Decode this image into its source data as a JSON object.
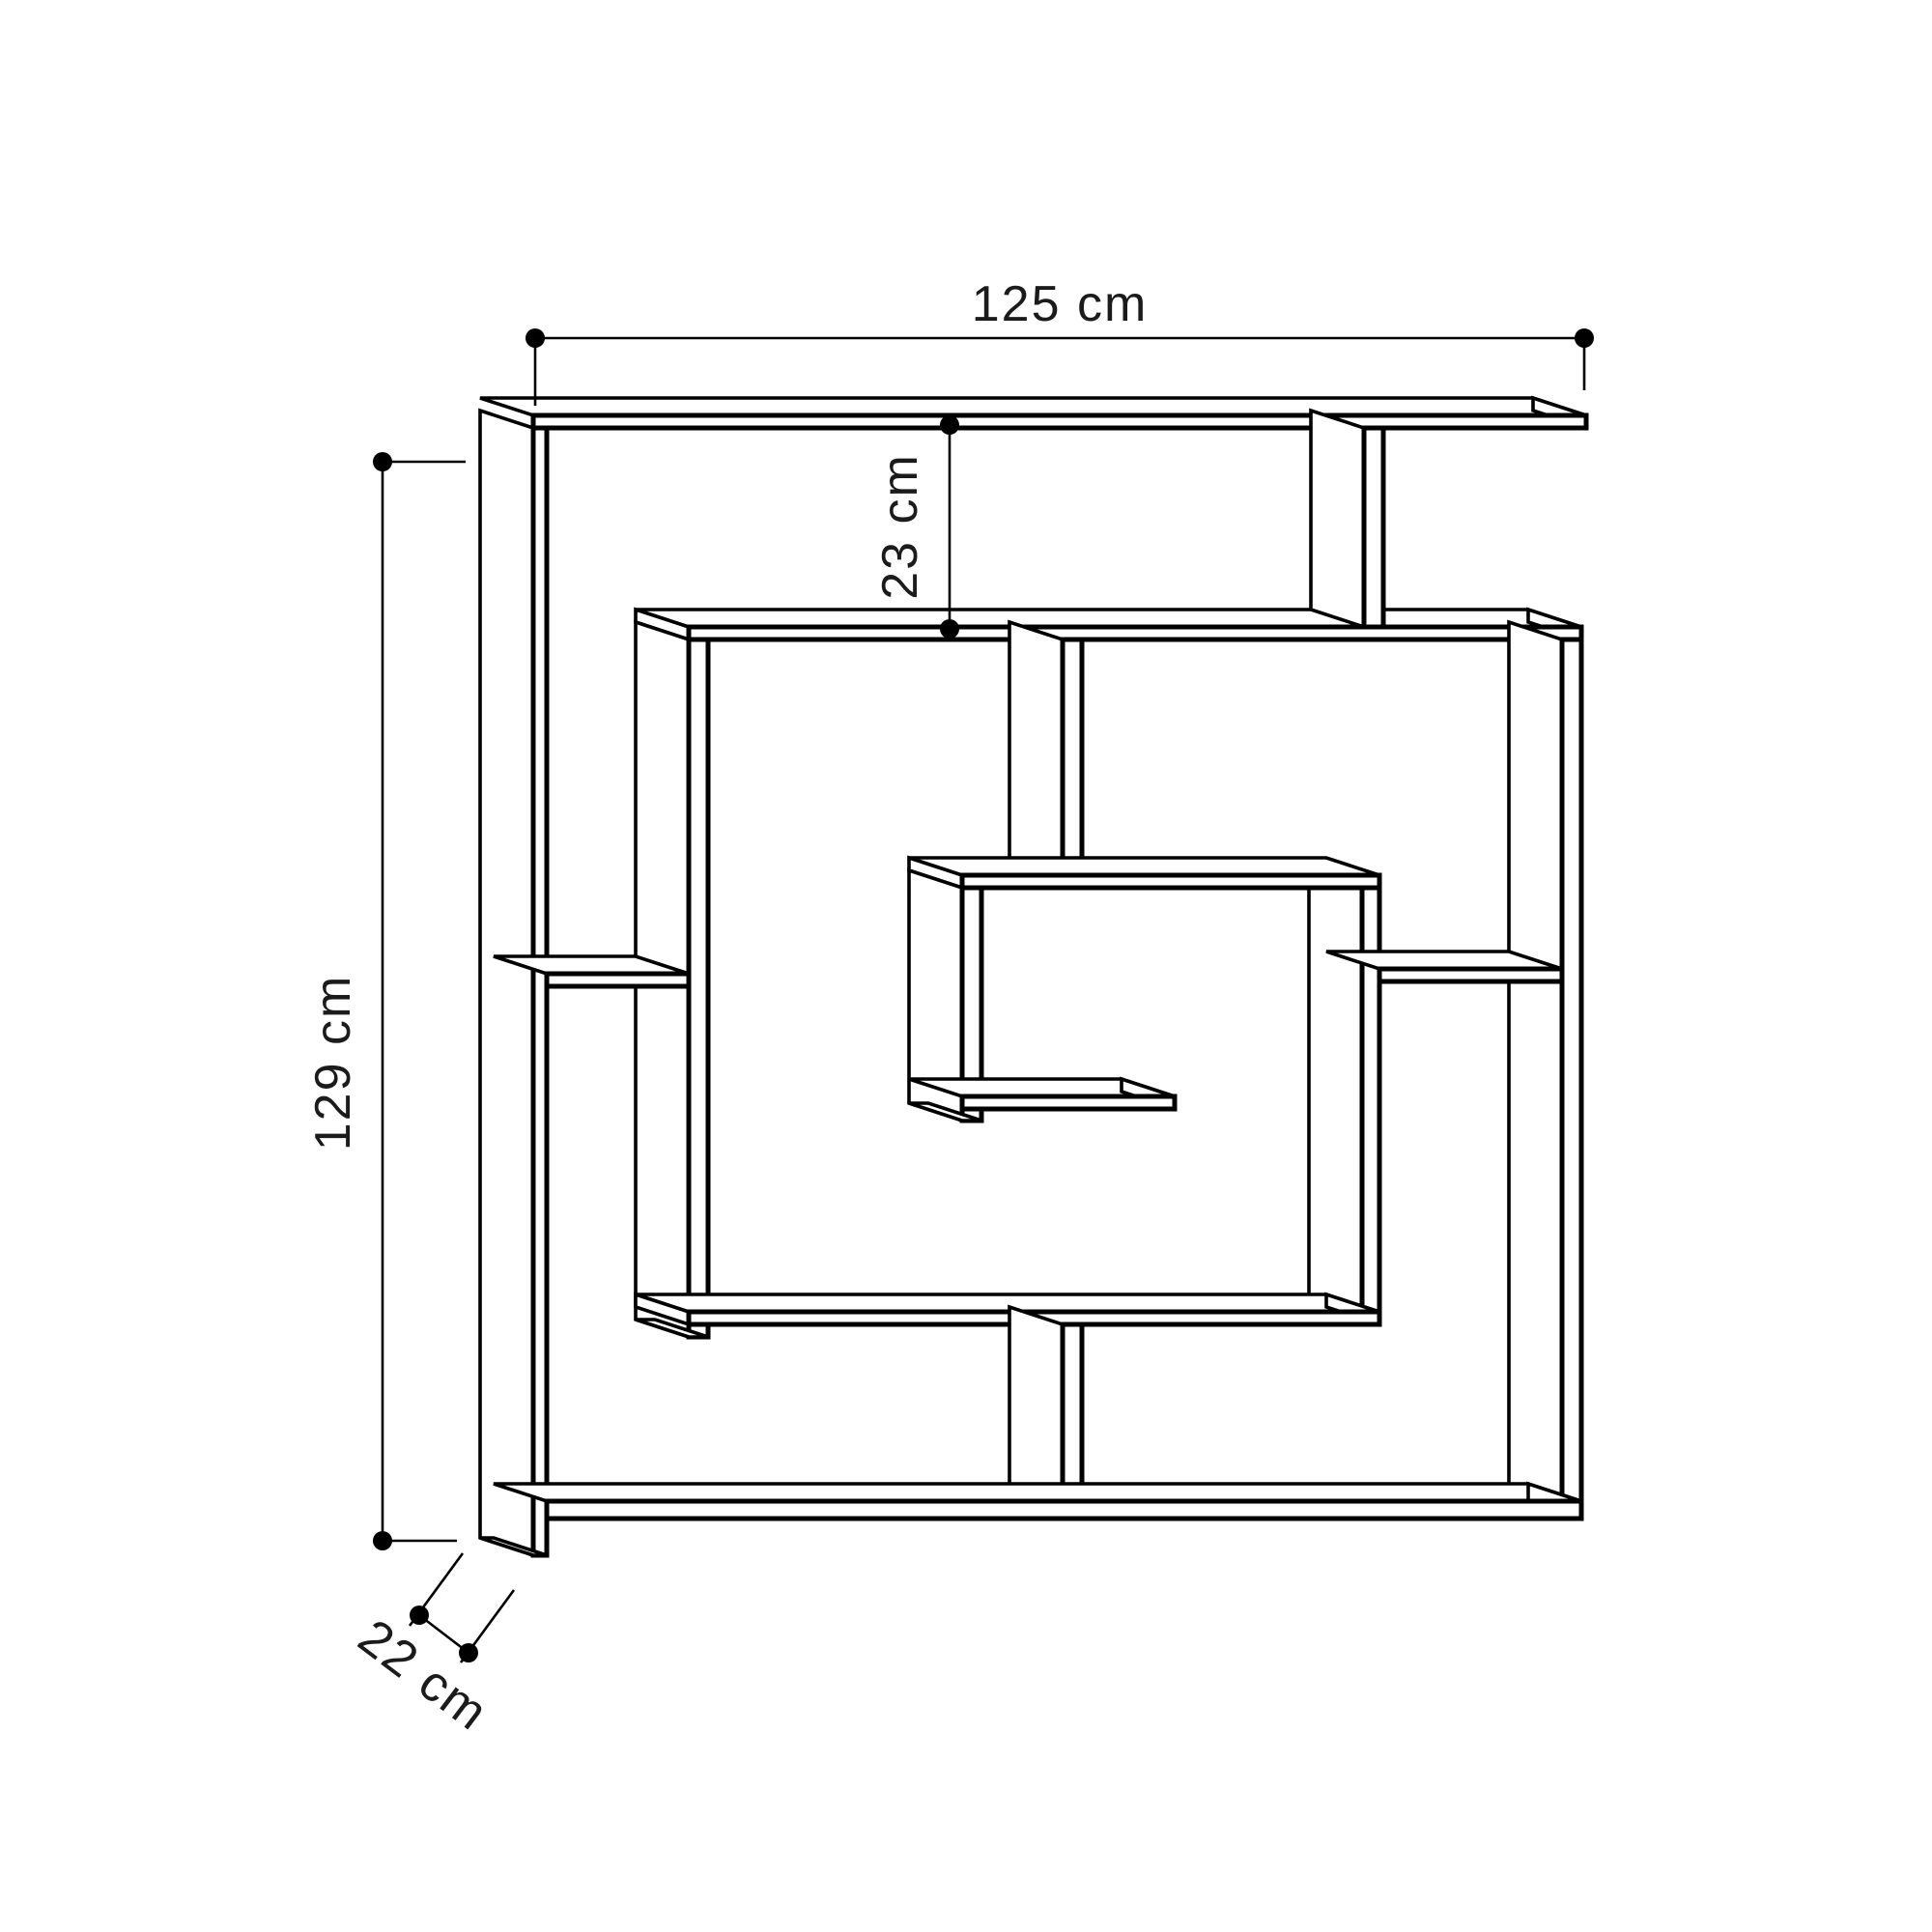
{
  "dims": {
    "width": "125 cm",
    "gap": "23 cm",
    "height": "129 cm",
    "depth": "22 cm"
  }
}
